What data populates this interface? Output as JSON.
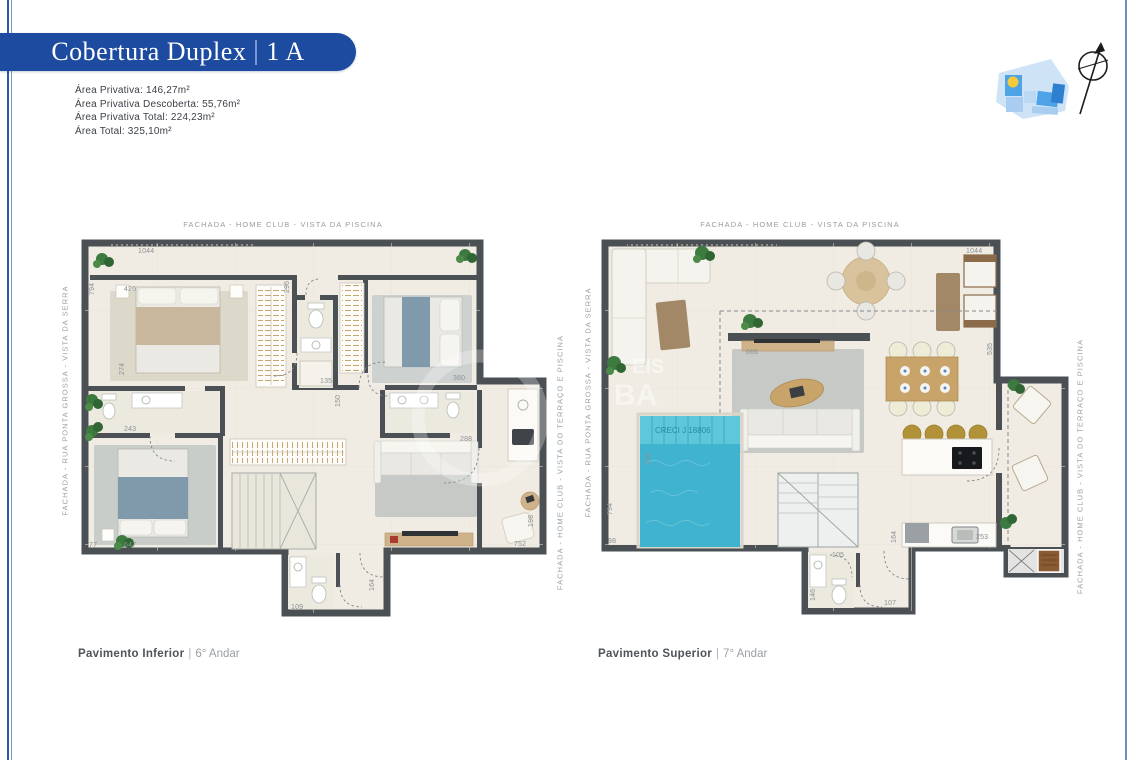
{
  "banner": {
    "title": "Cobertura Duplex",
    "separator": "|",
    "unit": "1 A"
  },
  "areas": {
    "line1": "Área Privativa:  146,27m²",
    "line2": "Área Privativa Descoberta: 55,76m²",
    "line3": "Área Privativa Total: 224,23m²",
    "line4": "Área Total: 325,10m²"
  },
  "facade_labels": {
    "top": "FACHADA - HOME CLUB - VISTA DA PISCINA",
    "west": "FACHADA - RUA PONTA GROSSA - VISTA DA SERRA",
    "east": "FACHADA - HOME CLUB - VISTA DO TERRAÇO E PISCINA"
  },
  "plan_inferior": {
    "caption": "Pavimento Inferior",
    "caption_sep": "|",
    "caption_floor": "6° Andar",
    "dims": {
      "top": "1044",
      "left": "794",
      "bed1": "426",
      "mid": "296",
      "left2": "274",
      "bath": "135",
      "bath2": "150",
      "wc": "243",
      "corner": "77",
      "bed2": "647",
      "suite": "360",
      "suite2": "288",
      "ter1": "198",
      "ter2": "752",
      "hall": "164",
      "lav": "109"
    }
  },
  "plan_superior": {
    "caption": "Pavimento Superior",
    "caption_sep": "|",
    "caption_floor": "7° Andar",
    "dims": {
      "top": "1044",
      "left": "794",
      "left2": "98",
      "pool": "234",
      "tv": "666",
      "right": "535",
      "counter": "253",
      "hall": "164",
      "lav": "146",
      "lav2": "105",
      "door": "107"
    }
  },
  "watermark": {
    "creci": "CRECI J 18806",
    "frag1": "EIS",
    "frag2": "BA"
  },
  "colors": {
    "banner_blue": "#1d4ba0",
    "wall": "#4b5054",
    "floor": "#f0ece3",
    "pool": "#3fb3cf",
    "wood": "#c8a46a",
    "edge_line": "#2d56a5"
  }
}
